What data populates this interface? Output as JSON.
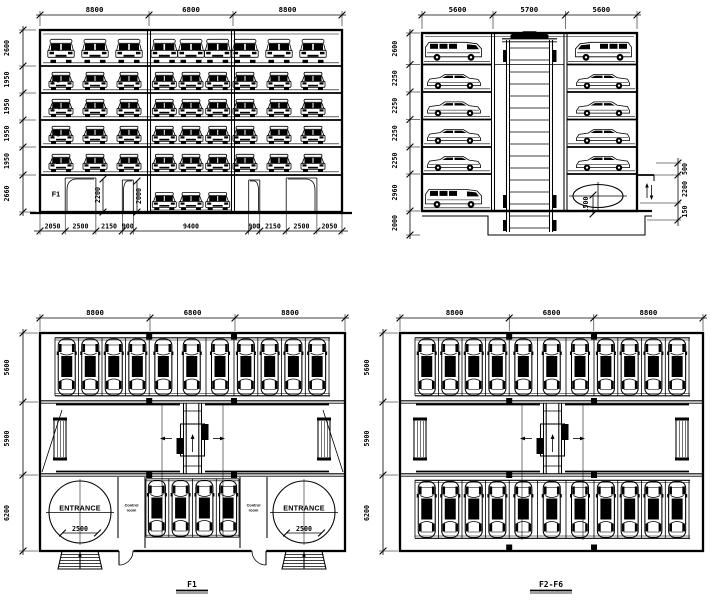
{
  "front_elevation": {
    "top_dims": [
      "8800",
      "6800",
      "8800"
    ],
    "left_dims": [
      "2600",
      "1950",
      "1950",
      "1950",
      "1950",
      "2660"
    ],
    "floors": [
      "F6",
      "F5",
      "F4",
      "F3",
      "F2",
      "F1"
    ],
    "door_height_dims": [
      "2200",
      "2000"
    ],
    "bottom_dims": [
      "2050",
      "2500",
      "2150",
      "900",
      "9400",
      "900",
      "2150",
      "2500",
      "2050"
    ]
  },
  "side_section": {
    "top_dims": [
      "5600",
      "5700",
      "5600"
    ],
    "left_dims": [
      "2600",
      "2250",
      "2250",
      "2250",
      "2250",
      "2960",
      "2000"
    ],
    "right_dims": [
      "500",
      "2200",
      "150"
    ],
    "pit_dim": "1500"
  },
  "plan_f1": {
    "top_dims": [
      "8800",
      "6800",
      "8800"
    ],
    "left_dims": [
      "5600",
      "5900",
      "6200"
    ],
    "entrance_label": "ENTRANCE",
    "turntable_dim": "2500",
    "control_room_line1": "Control",
    "control_room_line2": "room",
    "title": "F1"
  },
  "plan_f2f6": {
    "top_dims": [
      "8800",
      "6800",
      "8800"
    ],
    "left_dims": [
      "5600",
      "5900",
      "6200"
    ],
    "title": "F2-F6"
  }
}
